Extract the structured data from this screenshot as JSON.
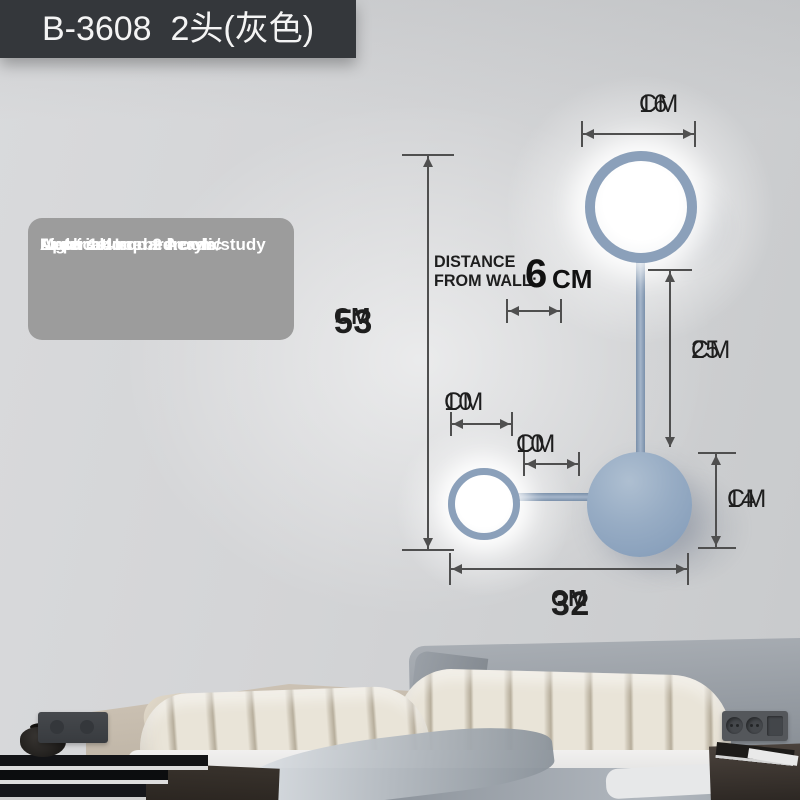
{
  "badge": {
    "text": "B-3608  2头(灰色)"
  },
  "specs": {
    "lines": [
      "Material: Iron + Acrylic",
      "Area: 1-4 square",
      "Application: bedroom/study",
      "Light source: 2 heads"
    ]
  },
  "dims": {
    "top_width": {
      "value": "16",
      "unit": "CM"
    },
    "total_height": {
      "value": "53",
      "unit": "CM"
    },
    "wall_distance": {
      "line1": "DISTANCE",
      "line2": "FROM WALL:",
      "value": "6",
      "unit": "CM"
    },
    "drop_rod": {
      "value": "25",
      "unit": "CM"
    },
    "head_offset": {
      "value": "10",
      "unit": "CM"
    },
    "arm_length": {
      "value": "10",
      "unit": "CM"
    },
    "disc_diameter": {
      "value": "14",
      "unit": "CM"
    },
    "total_width": {
      "value": "32",
      "unit": "CM"
    }
  },
  "colors": {
    "badge_bg": "#34373b",
    "specs_bg": "#9c9c9c",
    "lamp_ring": "#8ba0ba",
    "lamp_disc": "#92a8c2",
    "dim_lines": "#4f4f4f",
    "dim_text": "#1e1e1e",
    "wall": "#d3d4d6"
  }
}
